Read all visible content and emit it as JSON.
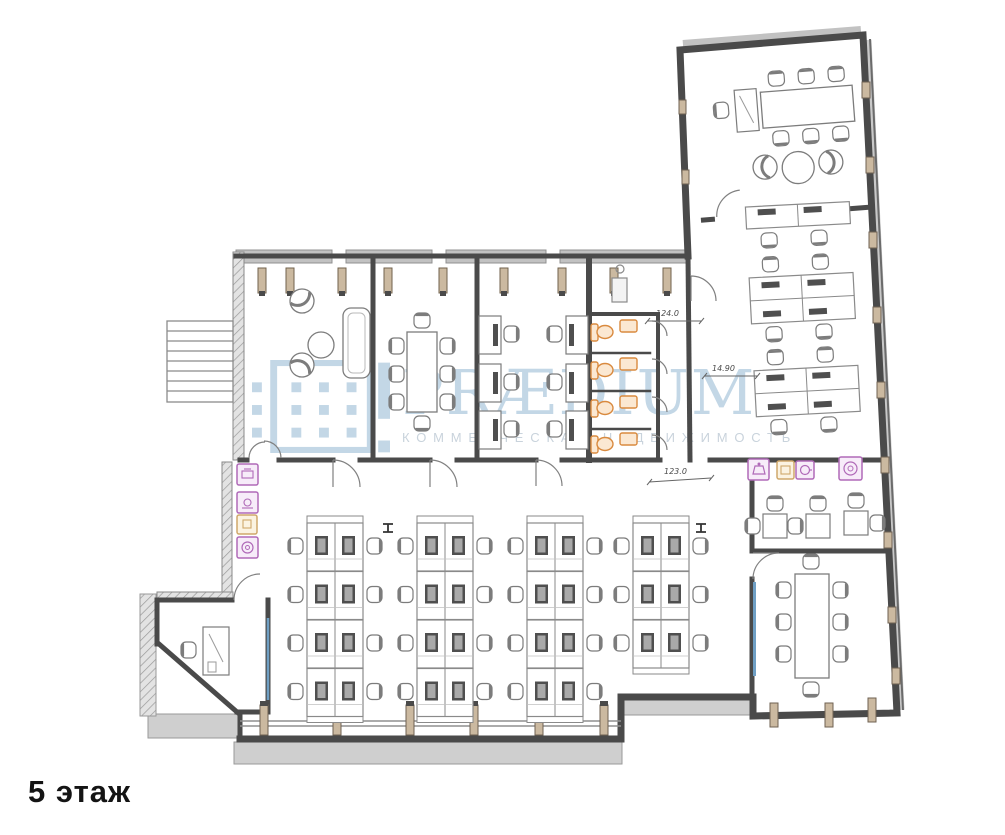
{
  "page": {
    "background": "#ffffff"
  },
  "floor_label": "5 этаж",
  "watermark": {
    "title": "PRÆDIUM",
    "subtitle": "КОММЕРЧЕСКАЯ НЕДВИЖИМОСТЬ",
    "title_color": "#c3d7e6",
    "subtitle_color": "#c9d3dc"
  },
  "dimensions": {
    "corridor_width": "124.0",
    "wing_width": "14.90",
    "opening_width": "123.0"
  },
  "colors": {
    "wall": "#4a4a4a",
    "furniture_line": "#7c7c7c",
    "wc_fixture": "#d98a3f",
    "appliance_purple": "#b06ab8",
    "appliance_tan": "#cfa86b",
    "glass": "#6f9fc4",
    "column": "#cbb9a0",
    "terrace": "#cfcfcf"
  },
  "legend_icons": {
    "print_corner": [
      "printer-icon",
      "scanner-icon",
      "kitchen-unit-icon",
      "copier-icon"
    ],
    "kitchen": [
      "kettle-icon",
      "microwave-icon",
      "coffee-cup-icon",
      "coffee-machine-icon"
    ],
    "wc": [
      "toilet-icon",
      "sink-icon"
    ]
  }
}
